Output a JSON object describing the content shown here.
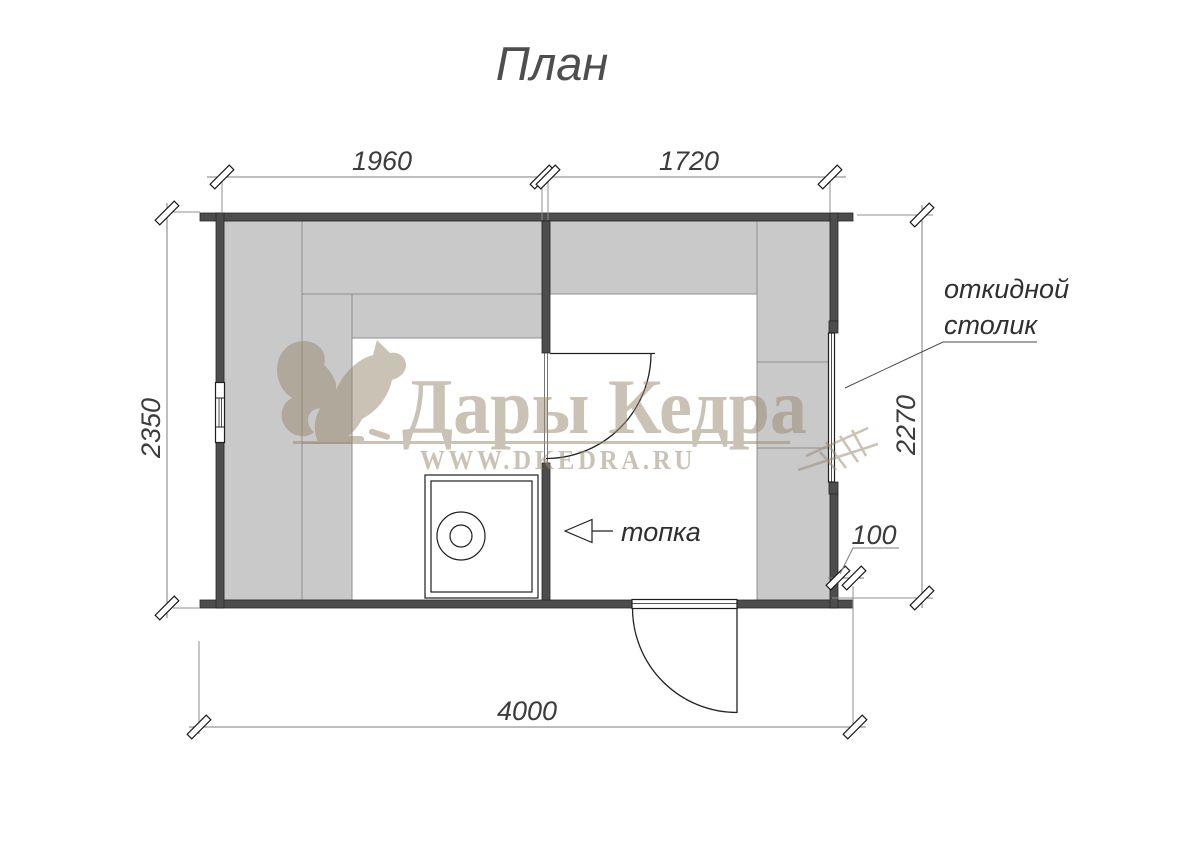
{
  "title": "План",
  "dimensions": {
    "sauna_width": "1960",
    "washroom_width": "1720",
    "left_height": "2350",
    "right_height": "2270",
    "total_width": "4000",
    "overhang": "100"
  },
  "labels": {
    "furnace": "топка",
    "folding_table_line1": "откидной",
    "folding_table_line2": "столик"
  },
  "watermark": {
    "brand": "Дары Кедра",
    "url": "WWW.DKEDRA.RU"
  },
  "colors": {
    "wall": "#4d4d4d",
    "bench": "#c9c9c9",
    "watermark": "#9c8b74",
    "dimension_line": "#7d7d7d",
    "text": "#3c3c3c"
  }
}
